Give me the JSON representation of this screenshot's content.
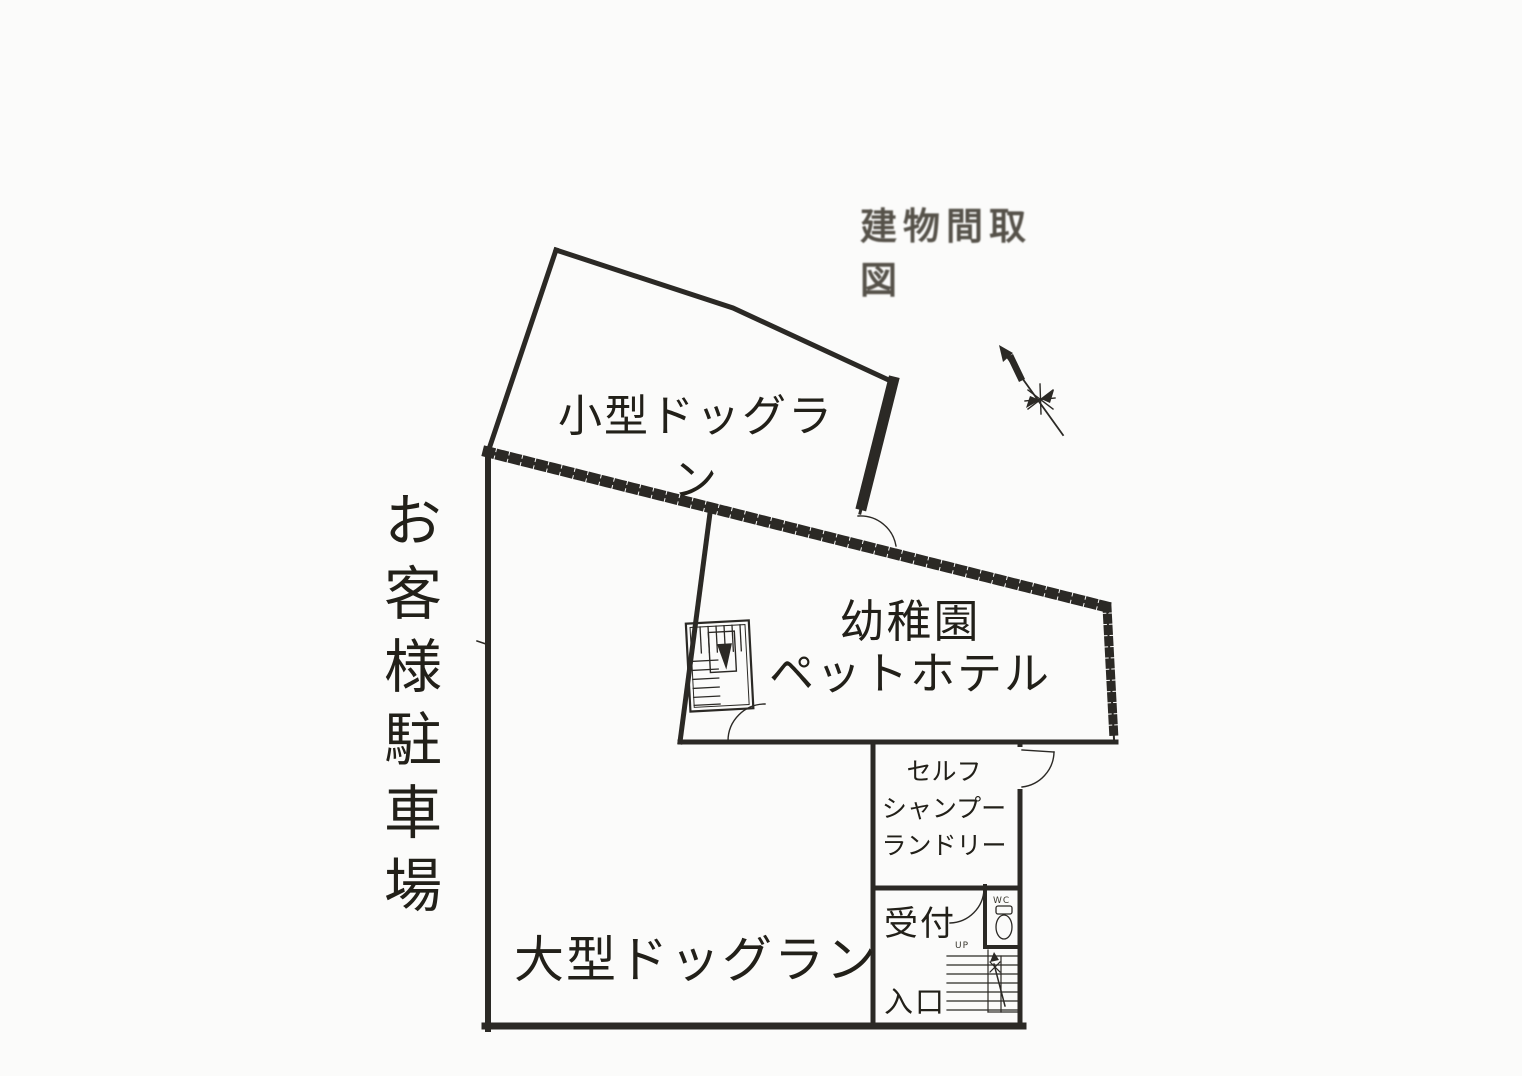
{
  "page": {
    "title_stamp": "建物間取図",
    "background_color": "#fbfbfa",
    "line_color": "#2b2925",
    "stamp_color": "#56524a"
  },
  "parking": {
    "label": "お客様駐車場"
  },
  "rooms": {
    "small_dog_run": {
      "label": "小型ドッグラン"
    },
    "pet_hotel": {
      "line1": "幼稚園",
      "line2": "ペットホテル"
    },
    "self_shampoo": {
      "line1": "セルフ",
      "line2": "シャンプー",
      "line3": "ランドリー"
    },
    "reception": {
      "label": "受付"
    },
    "entrance": {
      "label": "入口"
    },
    "large_dog_run": {
      "label": "大型ドッグラン"
    },
    "wc": {
      "label": "WC"
    },
    "stairs": {
      "up_label": "UP"
    }
  }
}
